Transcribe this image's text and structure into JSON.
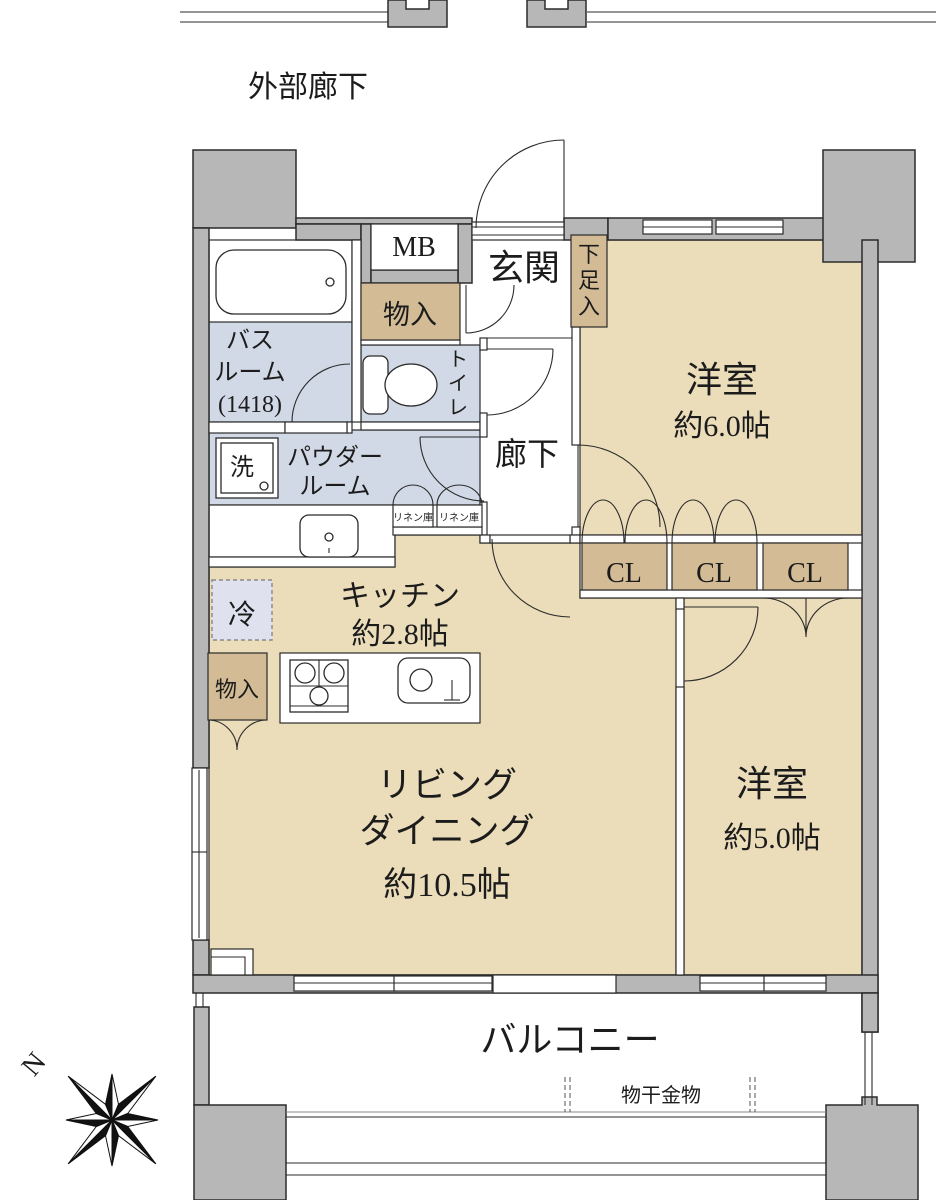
{
  "plan": {
    "exterior_corridor": "外部廊下",
    "entrance": "玄関",
    "shoe_box": "下足入",
    "meter_box": "MB",
    "storage_top": "物入",
    "bath": {
      "l1": "バス",
      "l2": "ルーム",
      "l3": "(1418)"
    },
    "toilet": "トイレ",
    "hallway": "廊下",
    "bedroom1": {
      "name": "洋室",
      "size": "約6.0帖"
    },
    "wash": "洗",
    "powder": {
      "l1": "パウダー",
      "l2": "ルーム"
    },
    "linen": "リネン庫",
    "closet": "CL",
    "fridge": "冷",
    "kitchen": {
      "name": "キッチン",
      "size": "約2.8帖"
    },
    "storage_kitchen": "物入",
    "living": {
      "l1": "リビング",
      "l2": "ダイニング",
      "size": "約10.5帖"
    },
    "bedroom2": {
      "name": "洋室",
      "size": "約5.0帖"
    },
    "balcony": "バルコニー",
    "laundry_hardware": "物干金物",
    "compass_north": "N"
  },
  "colors": {
    "wall_gray": "#b7b7b7",
    "room_beige": "#ebdcba",
    "closet_tan": "#d3bc95",
    "wet_area_blue": "#d2d9e6",
    "fridge_lavender": "#dfe2ee",
    "line": "#2b2b2b"
  }
}
